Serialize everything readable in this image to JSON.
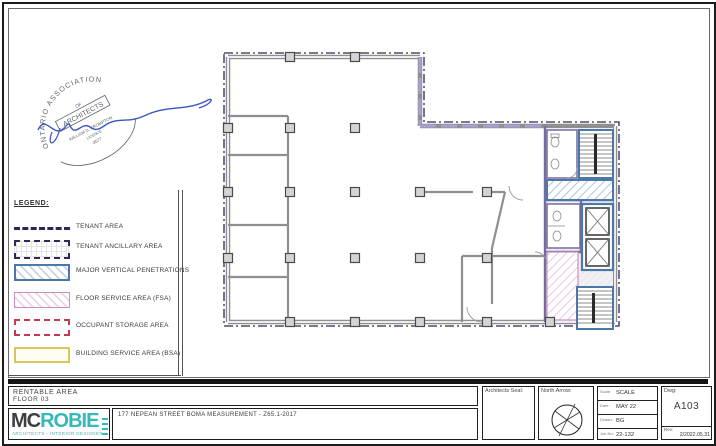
{
  "legend": {
    "title": "LEGEND:",
    "items": [
      {
        "label": "TENANT AREA"
      },
      {
        "label": "TENANT ANCILLARY AREA"
      },
      {
        "label": "MAJOR VERTICAL PENETRATIONS"
      },
      {
        "label": "FLOOR SERVICE AREA (FSA)"
      },
      {
        "label": "OCCUPANT STORAGE AREA"
      },
      {
        "label": "BUILDING SERVICE AREA (BSA)"
      }
    ]
  },
  "stamp": {
    "arc_text": "ONTARIO ASSOCIATION",
    "of": "OF",
    "architects": "ARCHITECTS",
    "name": "WILLIAM D. CROMPTON",
    "licence_label": "LICENCE",
    "licence_number": "3577"
  },
  "titleblock": {
    "title_line1": "RENTABLE AREA",
    "title_line2": "FLOOR 03",
    "logo": {
      "part1": "MC",
      "part2": "ROBIE",
      "subtitle": "ARCHITECTS  -  INTERIOR DESIGNERS"
    },
    "address": "177 NEPEAN STREET  BOMA MEASUREMENT - Z65.1-2017",
    "seal_label": "Architects Seal:",
    "north_label": "North Arrow:",
    "info_rows": [
      {
        "label": "Scale:",
        "value": "SCALE"
      },
      {
        "label": "Date:",
        "value": "MAY 22"
      },
      {
        "label": "Drawn:",
        "value": "BG"
      },
      {
        "label": "Job No:",
        "value": "22-132"
      }
    ],
    "dwg_label": "Dwg:",
    "dwg_number": "A103",
    "rev_label": "Rev:",
    "rev_value": "2/2022.05.31"
  },
  "colors": {
    "accent_teal": "#35b8b8",
    "tenant_boundary_navy": "#2a2a55",
    "penetration_blue": "#4a78a8",
    "fsa_pink": "#c98fc0",
    "storage_red": "#c23b4e",
    "bsa_yellow": "#d9c75a",
    "window_lavender": "#a99fd2",
    "signature_blue": "#3a57c4"
  }
}
